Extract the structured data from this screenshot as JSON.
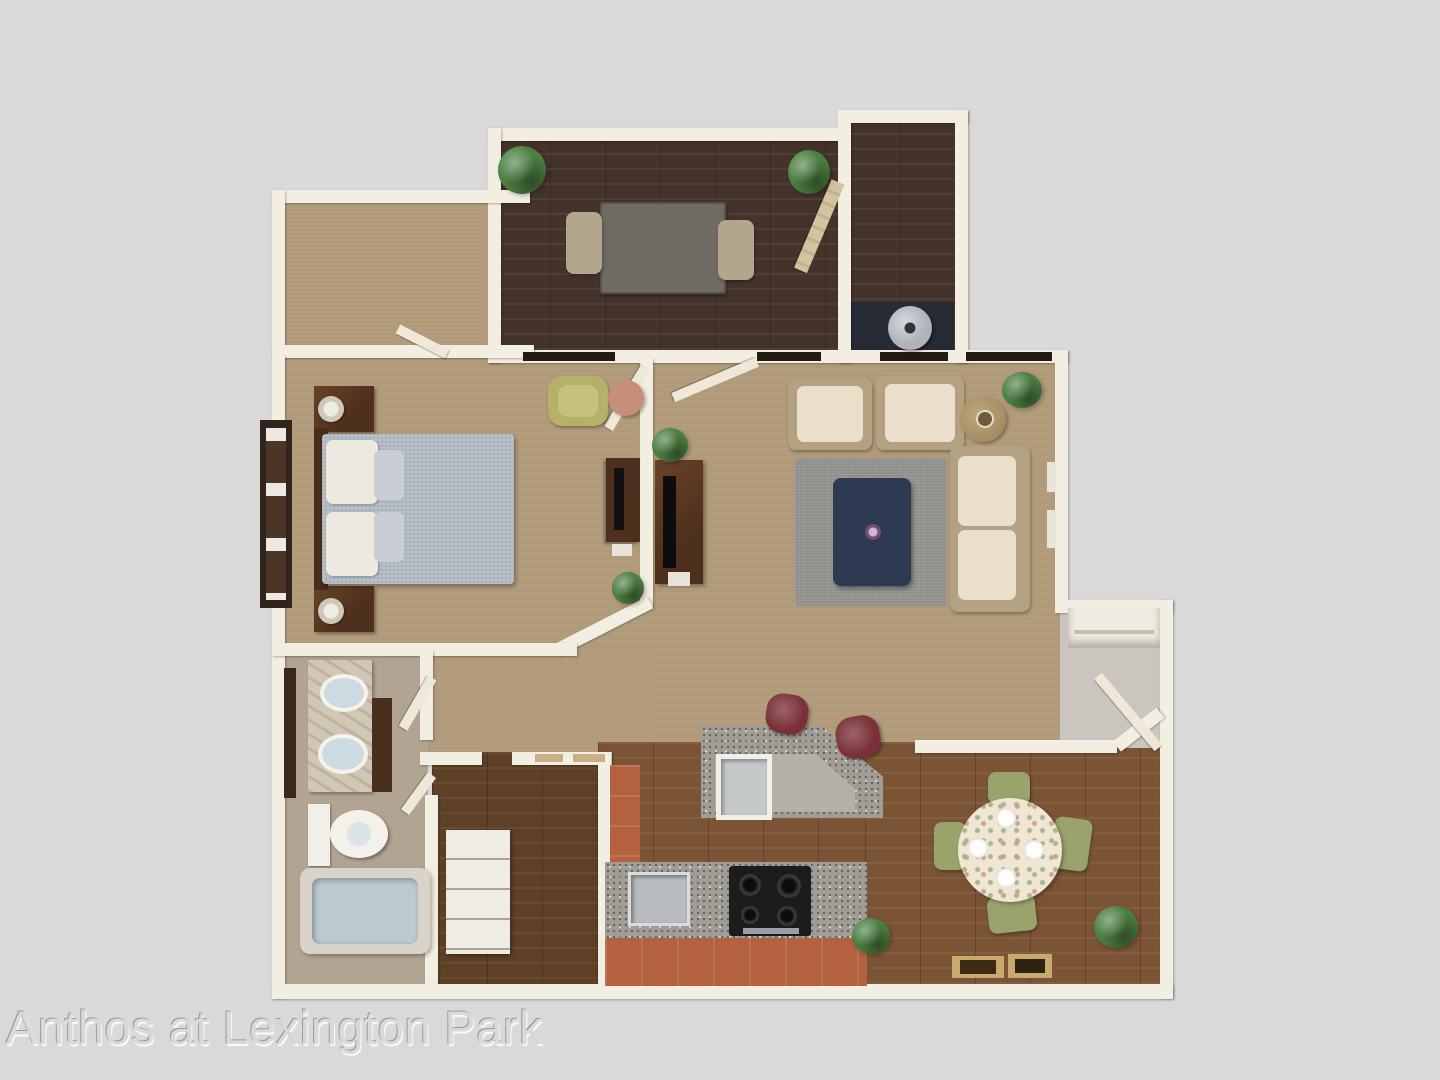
{
  "watermark": {
    "text": "Anthos at Lexington Park",
    "color": "#d9d9d9"
  },
  "canvas": {
    "width": 1440,
    "height": 1080,
    "background": "#d9d9d9"
  },
  "palette": {
    "wall": "#f3eee2",
    "carpet": "#b09a7a",
    "wood_dark": "#44332a",
    "wood_medium": "#7b5435",
    "wood_closet": "#5e4026",
    "bath_floor": "#b2a492",
    "entry_floor": "#cac6bf",
    "granite": "#a19d96",
    "terracotta": "#b4613f",
    "rug": "#908e89",
    "ottoman_navy": "#2d3a52",
    "upholstery_cream": "#e9dfca",
    "frame_tan": "#b3a181",
    "stool_red": "#7a3038",
    "chair_green": "#9ba36c",
    "plant": "#4c7f42",
    "comforter": "#adb5bf",
    "tub": "#bdc9d1",
    "furniture_wood": "#4c2f1c",
    "marble": "#d0c7b7",
    "threshold": "#241a10",
    "door_leaf": "#efe8d8",
    "den_table": "#6f6b63",
    "den_chair": "#b2a68c",
    "heater_gray": "#b0b4ba",
    "mat_navy": "#262b36",
    "yellow_chair": "#b5b06a",
    "side_table_pink": "#c58f79",
    "white": "#f1efe9"
  },
  "rooms": {
    "top_left": "walk-in-closet",
    "top_center": "den",
    "top_right": "utility-room",
    "middle_left": "bedroom",
    "middle_center": "hallway",
    "middle_right": "living-room",
    "bottom_left": "bathroom",
    "bottom_center_left": "closet",
    "bottom_center": "kitchen",
    "bottom_right": "dining-area",
    "right": "entry-nook"
  }
}
